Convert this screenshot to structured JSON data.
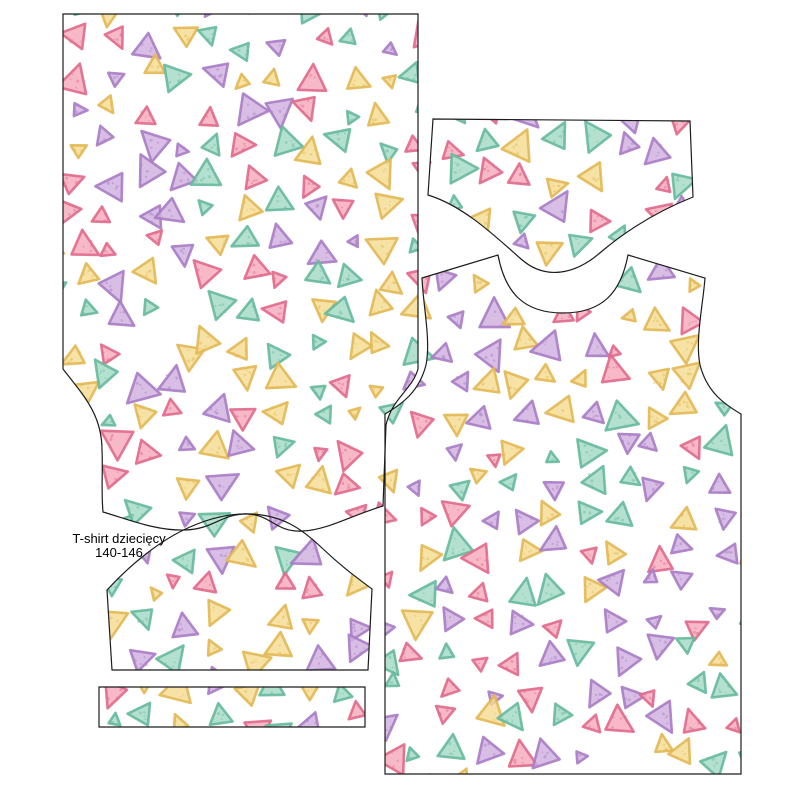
{
  "label": {
    "line1": "T-shirt dziecięcy",
    "line2": "140-146"
  },
  "fabric": {
    "background": "#ffffff",
    "piece_outline": "#1c1c1c",
    "label_color": "#000000",
    "triangle_colors": [
      {
        "name": "pink",
        "fill": "#f5a9bc",
        "stroke": "#e0698b"
      },
      {
        "name": "purple",
        "fill": "#d0aede",
        "stroke": "#a87cc5"
      },
      {
        "name": "yellow",
        "fill": "#f5dc92",
        "stroke": "#e2b854"
      },
      {
        "name": "teal",
        "fill": "#a2d9c5",
        "stroke": "#66b99c"
      }
    ]
  }
}
